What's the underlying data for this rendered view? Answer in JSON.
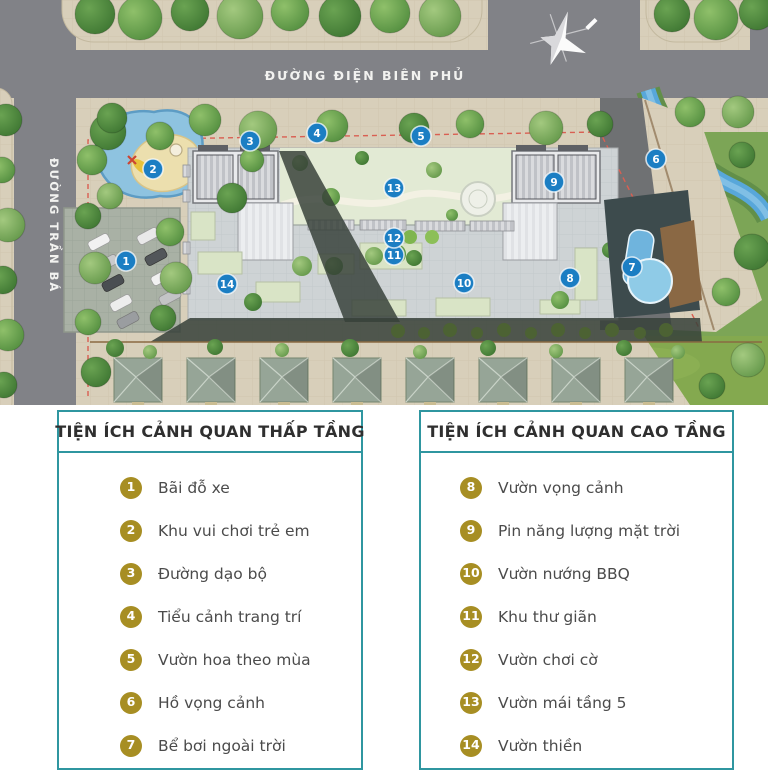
{
  "map": {
    "streets": {
      "top": "ĐƯỜNG ĐIỆN BIÊN PHỦ",
      "left": "ĐƯỜNG TRẦN BÁ"
    },
    "compass_icon": "north-arrow",
    "marker_color": "#1b7ec3",
    "markers": [
      {
        "number": "1",
        "x": 126,
        "y": 261
      },
      {
        "number": "2",
        "x": 153,
        "y": 169
      },
      {
        "number": "3",
        "x": 250,
        "y": 141
      },
      {
        "number": "4",
        "x": 317,
        "y": 133
      },
      {
        "number": "5",
        "x": 421,
        "y": 136
      },
      {
        "number": "6",
        "x": 656,
        "y": 159
      },
      {
        "number": "7",
        "x": 632,
        "y": 267
      },
      {
        "number": "8",
        "x": 570,
        "y": 278
      },
      {
        "number": "9",
        "x": 554,
        "y": 182
      },
      {
        "number": "10",
        "x": 464,
        "y": 283
      },
      {
        "number": "11",
        "x": 394,
        "y": 255
      },
      {
        "number": "12",
        "x": 394,
        "y": 238
      },
      {
        "number": "13",
        "x": 394,
        "y": 188
      },
      {
        "number": "14",
        "x": 227,
        "y": 284
      }
    ]
  },
  "legend": {
    "accent_color": "#2f96a0",
    "badge_color": "#a78e23",
    "low_rise": {
      "title": "TIỆN ÍCH CẢNH QUAN THẤP TẦNG",
      "items": [
        {
          "number": "1",
          "label": "Bãi đỗ xe"
        },
        {
          "number": "2",
          "label": "Khu vui chơi trẻ em"
        },
        {
          "number": "3",
          "label": "Đường dạo bộ"
        },
        {
          "number": "4",
          "label": "Tiểu cảnh trang trí"
        },
        {
          "number": "5",
          "label": "Vườn hoa theo mùa"
        },
        {
          "number": "6",
          "label": "Hồ vọng cảnh"
        },
        {
          "number": "7",
          "label": "Bể bơi ngoài trời"
        }
      ]
    },
    "high_rise": {
      "title": "TIỆN ÍCH CẢNH QUAN CAO TẦNG",
      "items": [
        {
          "number": "8",
          "label": "Vườn vọng cảnh"
        },
        {
          "number": "9",
          "label": "Pin năng lượng mặt trời"
        },
        {
          "number": "10",
          "label": "Vườn nướng BBQ"
        },
        {
          "number": "11",
          "label": "Khu thư giãn"
        },
        {
          "number": "12",
          "label": "Vườn chơi cờ"
        },
        {
          "number": "13",
          "label": "Vườn mái tầng 5"
        },
        {
          "number": "14",
          "label": "Vườn thiền"
        }
      ]
    }
  }
}
